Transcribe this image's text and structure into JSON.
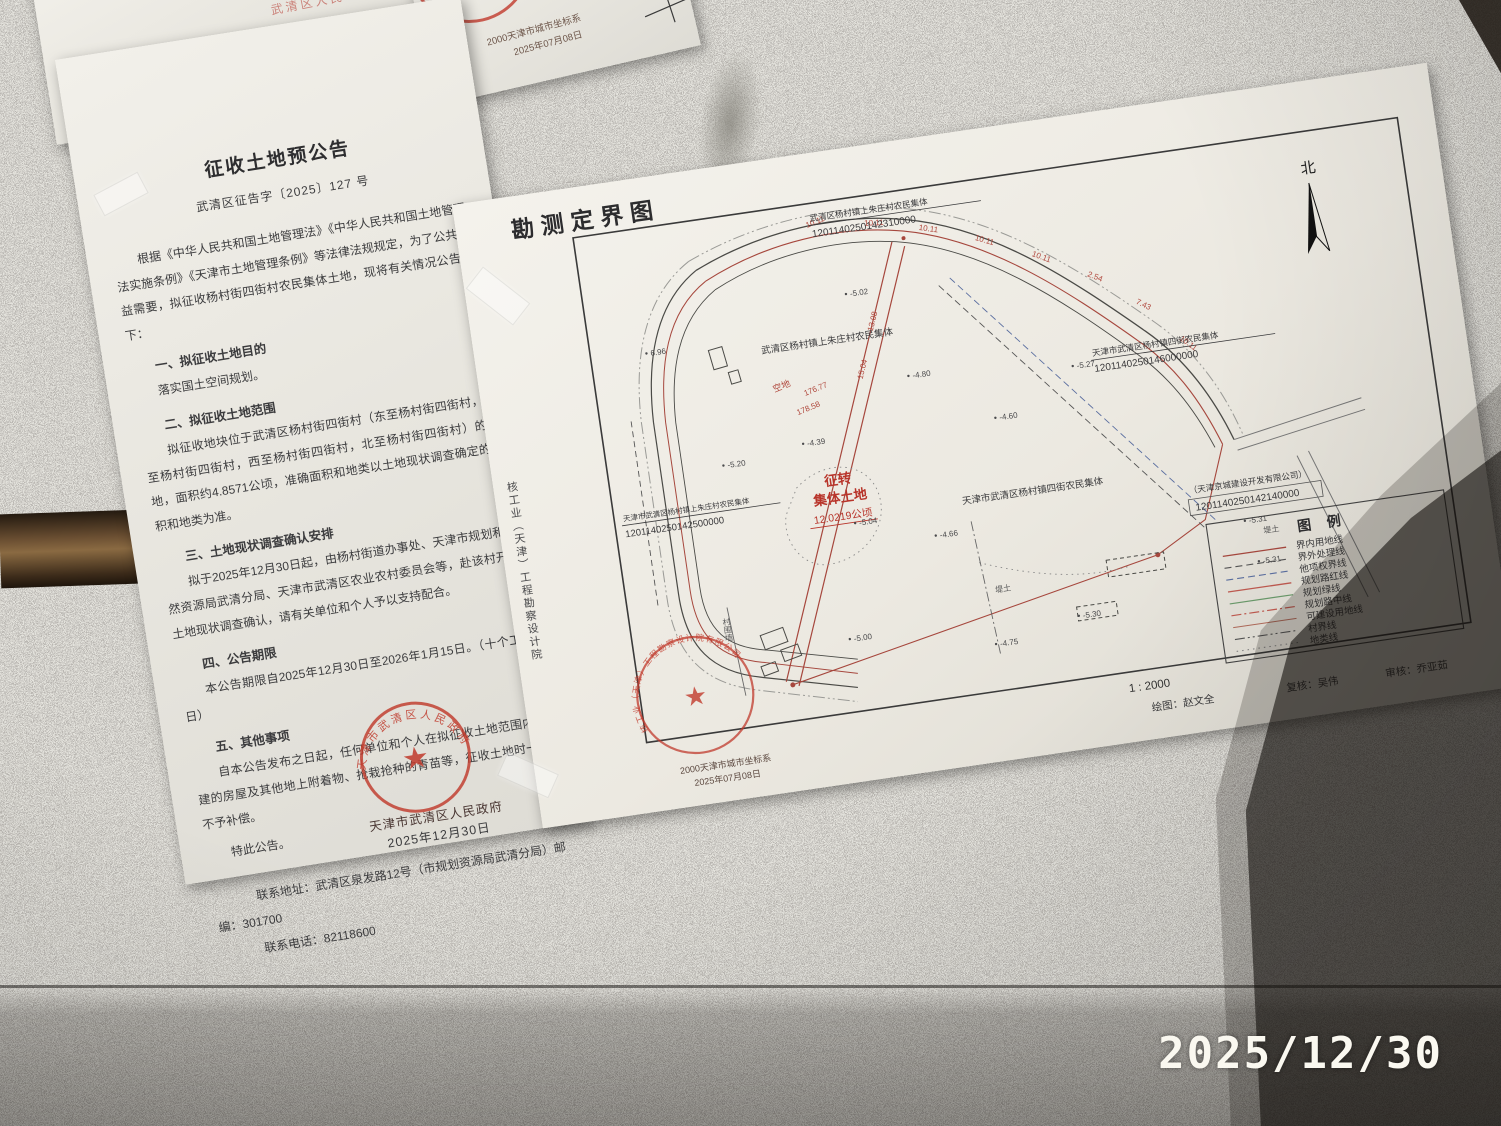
{
  "photo": {
    "timestamp": "2025/12/30"
  },
  "colors": {
    "seal_red": "#c03a2c",
    "boundary_red": "#a6473d",
    "ink": "#3c3c3e"
  },
  "fragment_top_left": {
    "date": "2025 年 12 月 30 日",
    "seal_hint": "武清区人民政府"
  },
  "fragment_top_center": {
    "line1": "2000天津市城市坐标系",
    "line2": "2025年07月08日"
  },
  "notice": {
    "title": "征收土地预公告",
    "doc_no": "武清区征告字〔2025〕127 号",
    "intro": "根据《中华人民共和国土地管理法》《中华人民共和国土地管理法实施条例》《天津市土地管理条例》等法律法规规定，为了公共利益需要，拟征收杨村街四街村农民集体土地，现将有关情况公告如下：",
    "sections": [
      {
        "heading": "一、拟征收土地目的",
        "body": "落实国土空间规划。"
      },
      {
        "heading": "二、拟征收土地范围",
        "body": "拟征收地块位于武清区杨村街四街村（东至杨村街四街村，南至杨村街四街村，西至杨村街四街村，北至杨村街四街村）的土地，面积约4.8571公顷，准确面积和地类以土地现状调查确定的面积和地类为准。"
      },
      {
        "heading": "三、土地现状调查确认安排",
        "body": "拟于2025年12月30日起，由杨村街道办事处、天津市规划和自然资源局武清分局、天津市武清区农业农村委员会等，赴该村开展土地现状调查确认，请有关单位和个人予以支持配合。"
      },
      {
        "heading": "四、公告期限",
        "body": "本公告期限自2025年12月30日至2026年1月15日。（十个工作日）"
      },
      {
        "heading": "五、其他事项",
        "body": "自本公告发布之日起，任何单位和个人在拟征收土地范围内抢建的房屋及其他地上附着物、抢栽抢种的青苗等，征收土地时一律不予补偿。"
      }
    ],
    "closing": "特此公告。",
    "contact_address": "联系地址：武清区泉发路12号（市规划资源局武清分局）邮编：301700",
    "contact_phone": "联系电话：82118600",
    "issuer": "天津市武清区人民政府",
    "date": "2025年12月30日",
    "seal_text": "天津市武清区人民政府"
  },
  "map": {
    "title": "勘测定界图",
    "north_label": "北",
    "scale": "1 : 2000",
    "side_text": "核工业（天津）工程勘察设计院",
    "credits": {
      "draw": "绘图：赵文全",
      "recheck": "复核：吴伟",
      "review": "审核：乔亚茹"
    },
    "seal": {
      "org": "核工业（天津）工程勘察设计院有限公司",
      "line1": "2000天津市城市坐标系",
      "line2": "2025年07月08日"
    },
    "parcels": [
      {
        "name": "武清区杨村镇上朱庄村农民集体",
        "code": "1201140250142310000"
      },
      {
        "name": "天津市武清区杨村镇四街农民集体",
        "code": "1201140250146000000"
      },
      {
        "name": "天津市武清区杨村镇上朱庄村农民集体",
        "code": "1201140250142500000"
      },
      {
        "name": "武清区杨村镇上朱庄村农民集体",
        "code": ""
      },
      {
        "name": "天津市武清区杨村镇四街农民集体",
        "code": ""
      },
      {
        "name": "（天津京城建设开发有限公司）",
        "code": "1201140250142140000"
      }
    ],
    "highlight": {
      "line1": "征转",
      "line2": "集体土地",
      "line3": "12.0219公顷"
    },
    "labels": {
      "vacant": "空地",
      "dike": "堤土",
      "wall": "村围墙",
      "d1": "176.77",
      "d2": "178.58"
    },
    "band_numbers": [
      "10.11",
      "10.11",
      "10.11",
      "10.11",
      "10.11",
      "2.54",
      "7.43",
      "10.11"
    ],
    "road_numbers": [
      "13.08",
      "15.04"
    ],
    "spot_elevations": [
      "-5.02",
      "-4.80",
      "-5.20",
      "-5.27",
      "-4.60",
      "-4.39",
      "-5.04",
      "-4.66",
      "-5.31",
      "-4.75",
      "-5.00",
      "-5.30",
      "6.96",
      "-5.31"
    ],
    "legend": {
      "title": "图  例",
      "items": [
        {
          "label": "界内用地线",
          "style": "solid",
          "color": "#a6473d"
        },
        {
          "label": "界外处理线",
          "style": "dashed",
          "color": "#555555"
        },
        {
          "label": "他项权界线",
          "style": "dashed",
          "color": "#5a6ea0"
        },
        {
          "label": "规划路红线",
          "style": "solid",
          "color": "#c05a50"
        },
        {
          "label": "规划绿线",
          "style": "solid",
          "color": "#6a9a6a"
        },
        {
          "label": "规划路中线",
          "style": "dashdot",
          "color": "#c05a50"
        },
        {
          "label": "可建设用地线",
          "style": "solid",
          "color": "#b06a5a"
        },
        {
          "label": "村界线",
          "style": "dashdotdot",
          "color": "#555555"
        },
        {
          "label": "地类线",
          "style": "dotted",
          "color": "#888888"
        }
      ]
    }
  }
}
